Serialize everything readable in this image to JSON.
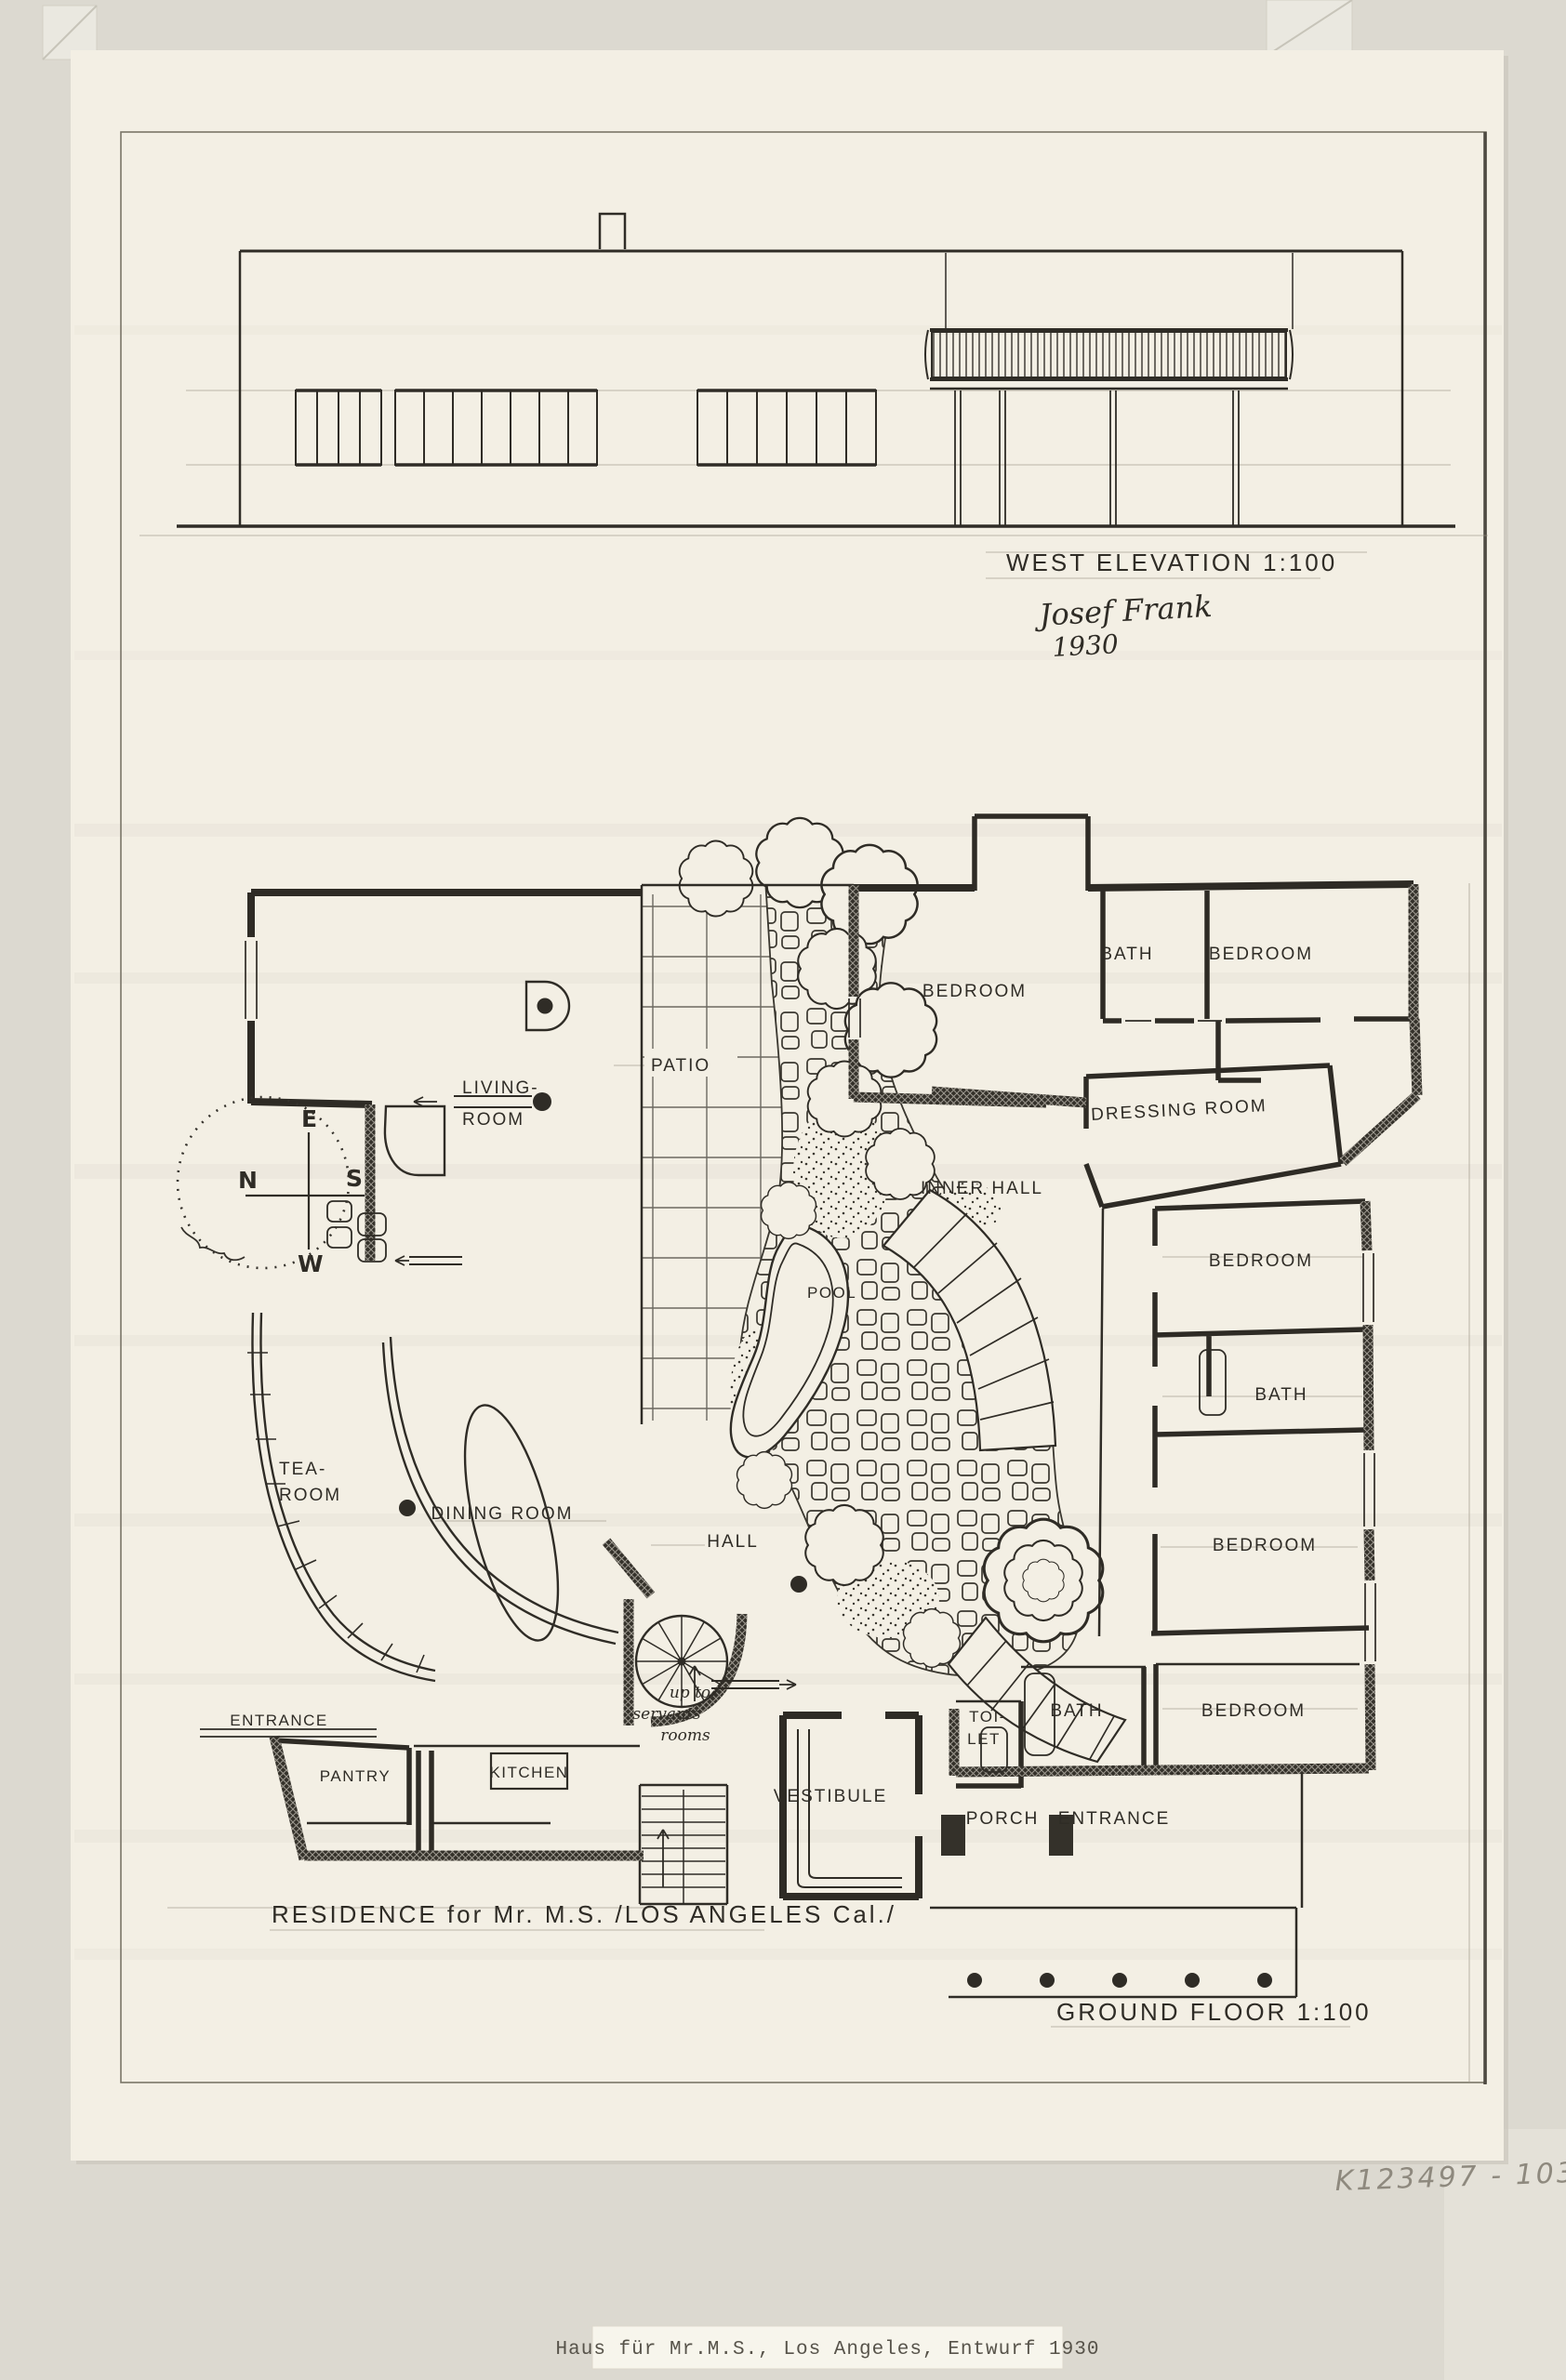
{
  "titles": {
    "elevation": "WEST ELEVATION 1:100",
    "ground_floor": "GROUND FLOOR 1:100",
    "residence": "RESIDENCE for Mr. M.S. /LOS ANGELES Cal./"
  },
  "signature": {
    "name": "Josef Frank",
    "year": "1930"
  },
  "annotations": {
    "archive_number": "K123497 - 103",
    "typed_label": "Haus für Mr.M.S., Los Angeles, Entwurf 1930"
  },
  "rooms": {
    "patio": "PATIO",
    "living": [
      "LIVING-",
      "ROOM"
    ],
    "bedroom_top": "BEDROOM",
    "bath_top": "BATH",
    "bedroom_top_right": "BEDROOM",
    "dressing": "DRESSING ROOM",
    "inner_hall": "INNER HALL",
    "bedroom_mid": "BEDROOM",
    "bath_mid": "BATH",
    "bedroom_low": "BEDROOM",
    "pool": "POOL",
    "tea": [
      "TEA-",
      "ROOM"
    ],
    "dining": "DINING ROOM",
    "hall": "HALL",
    "entrance_side": "ENTRANCE",
    "pantry": "PANTRY",
    "kitchen": "KITCHEN",
    "vestibule": "VESTIBULE",
    "toilet": [
      "TOI-",
      "LET"
    ],
    "bath_south": "BATH",
    "bedroom_south": "BEDROOM",
    "porch": "PORCH",
    "entrance_main": "ENTRANCE",
    "stair_note": [
      "up to",
      "servants",
      "rooms"
    ]
  },
  "compass": {
    "top": "E",
    "left": "N",
    "right": "S",
    "bottom": "W"
  },
  "colors": {
    "paper": "#f3efe4",
    "mat": "#dcd9d0",
    "ink": "#2f2c26",
    "pencil": "#9b9484"
  }
}
